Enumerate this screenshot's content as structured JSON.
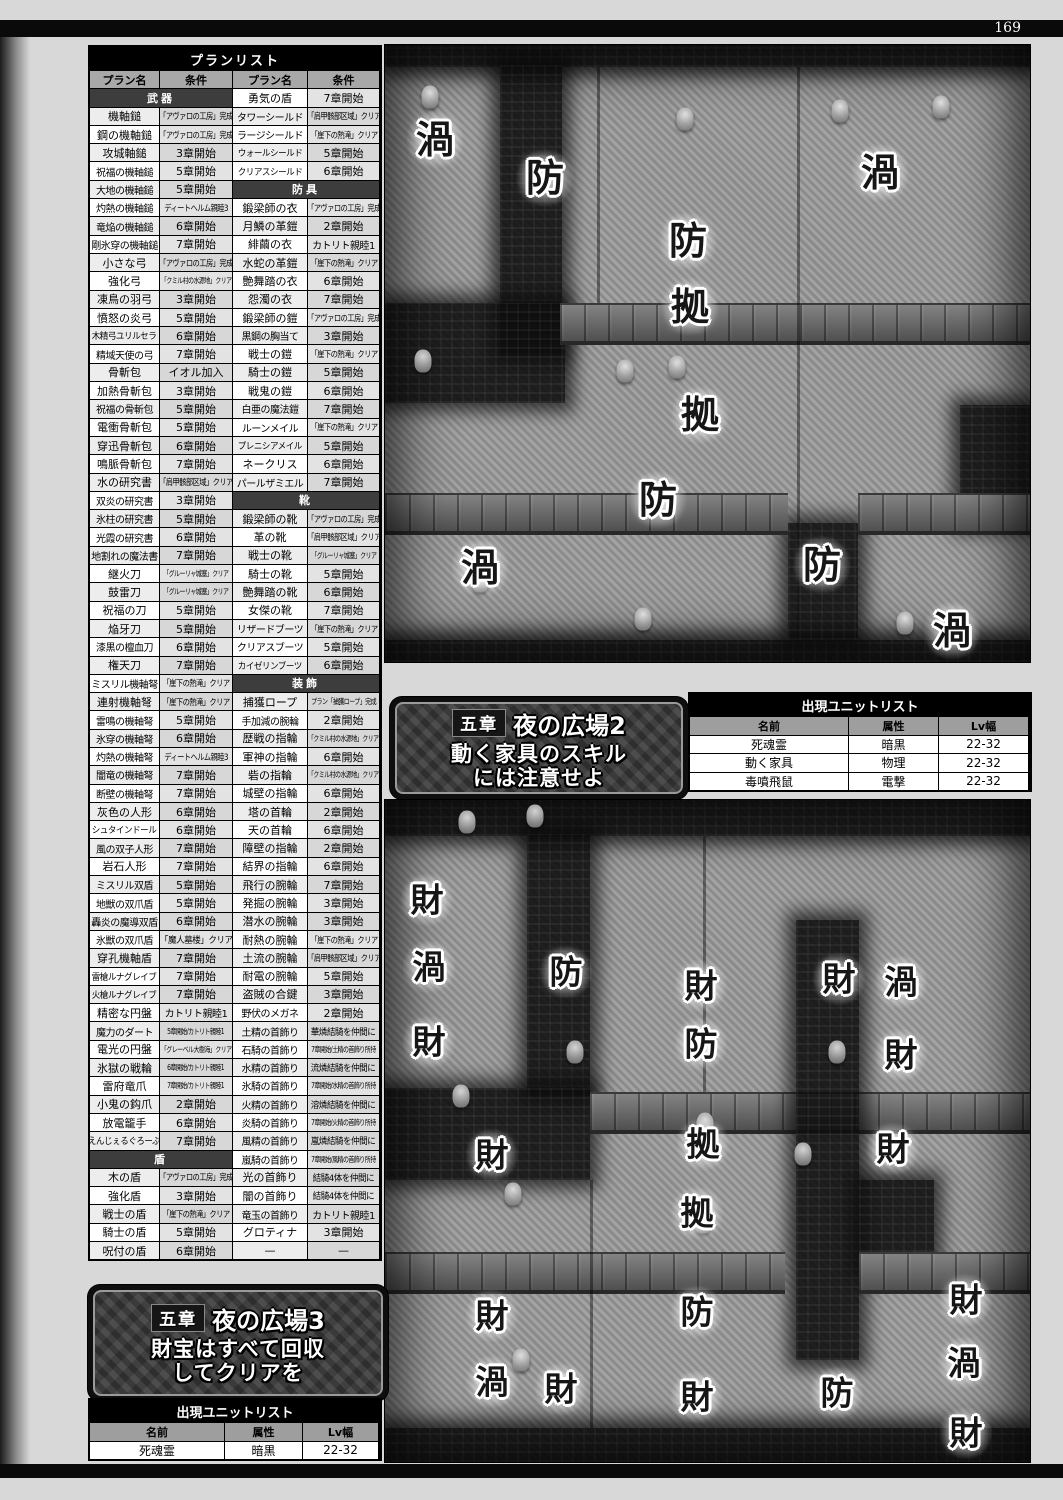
{
  "page": {
    "number": "169"
  },
  "plan_table": {
    "title": "プランリスト",
    "headers": [
      "プラン名",
      "条件",
      "プラン名",
      "条件"
    ],
    "rows": [
      {
        "ls": "武器",
        "r": [
          "勇気の盾",
          "7章開始"
        ]
      },
      {
        "l": [
          "機軸鎚",
          "「アヴァロの工房」完成"
        ],
        "r": [
          "タワーシールド",
          "「肩甲骸部区域」クリア"
        ]
      },
      {
        "l": [
          "鋼の機軸鎚",
          "「アヴァロの工房」完成"
        ],
        "r": [
          "ラージシールド",
          "「崖下の熱滝」クリア"
        ]
      },
      {
        "l": [
          "攻城軸鎚",
          "3章開始"
        ],
        "r": [
          "ウォールシールド",
          "5章開始"
        ]
      },
      {
        "l": [
          "祝福の機軸鎚",
          "5章開始"
        ],
        "r": [
          "クリアスシールド",
          "6章開始"
        ]
      },
      {
        "l": [
          "大地の機軸鎚",
          "5章開始"
        ],
        "rs": "防具"
      },
      {
        "l": [
          "灼熱の機軸鎚",
          "ディートヘルム親睦3"
        ],
        "r": [
          "鍛梁師の衣",
          "「アヴァロの工房」完成"
        ]
      },
      {
        "l": [
          "竜焔の機軸鎚",
          "6章開始"
        ],
        "r": [
          "月鱗の革鎧",
          "2章開始"
        ]
      },
      {
        "l": [
          "剛氷穿の機軸鎚",
          "7章開始"
        ],
        "r": [
          "緋繭の衣",
          "カトリト親睦1"
        ]
      },
      {
        "l": [
          "小さな弓",
          "「アヴァロの工房」完成"
        ],
        "r": [
          "水蛇の革鎧",
          "「崖下の熱滝」クリア"
        ]
      },
      {
        "l": [
          "強化弓",
          "「クミル村の水源地」クリア"
        ],
        "r": [
          "艶舞踏の衣",
          "6章開始"
        ]
      },
      {
        "l": [
          "凍鳥の羽弓",
          "3章開始"
        ],
        "r": [
          "怨濁の衣",
          "7章開始"
        ]
      },
      {
        "l": [
          "憤怒の炎弓",
          "5章開始"
        ],
        "r": [
          "鍛梁師の鎧",
          "「アヴァロの工房」完成"
        ]
      },
      {
        "l": [
          "木精弓ユリルセラ",
          "6章開始"
        ],
        "r": [
          "黒鋼の胸当て",
          "3章開始"
        ]
      },
      {
        "l": [
          "精域天使の弓",
          "7章開始"
        ],
        "r": [
          "戦士の鎧",
          "「崖下の熱滝」クリア"
        ]
      },
      {
        "l": [
          "骨斬包",
          "イオル加入"
        ],
        "r": [
          "騎士の鎧",
          "5章開始"
        ]
      },
      {
        "l": [
          "加熱骨斬包",
          "3章開始"
        ],
        "r": [
          "戦鬼の鎧",
          "6章開始"
        ]
      },
      {
        "l": [
          "祝福の骨斬包",
          "5章開始"
        ],
        "r": [
          "白亜の魔法鎧",
          "7章開始"
        ]
      },
      {
        "l": [
          "電衝骨斬包",
          "5章開始"
        ],
        "r": [
          "ルーンメイル",
          "「崖下の熱滝」クリア"
        ]
      },
      {
        "l": [
          "穿迅骨斬包",
          "6章開始"
        ],
        "r": [
          "プレニシアメイル",
          "5章開始"
        ]
      },
      {
        "l": [
          "鳴脈骨斬包",
          "7章開始"
        ],
        "r": [
          "ネークリス",
          "6章開始"
        ]
      },
      {
        "l": [
          "水の研究書",
          "「肩甲骸部区域」クリア"
        ],
        "r": [
          "パールザミエル",
          "7章開始"
        ]
      },
      {
        "l": [
          "双炎の研究書",
          "3章開始"
        ],
        "rs": "靴"
      },
      {
        "l": [
          "氷柱の研究書",
          "5章開始"
        ],
        "r": [
          "鍛梁師の靴",
          "「アヴァロの工房」完成"
        ]
      },
      {
        "l": [
          "光霞の研究書",
          "6章開始"
        ],
        "r": [
          "革の靴",
          "「肩甲骸部区域」クリア"
        ]
      },
      {
        "l": [
          "地割れの魔法書",
          "7章開始"
        ],
        "r": [
          "戦士の靴",
          "「グルーリャ城塞」クリア"
        ]
      },
      {
        "l": [
          "継火刀",
          "「グルーリャ城塞」クリア"
        ],
        "r": [
          "騎士の靴",
          "5章開始"
        ]
      },
      {
        "l": [
          "鼓雷刀",
          "「グルーリャ城塞」クリア"
        ],
        "r": [
          "艶舞踏の靴",
          "6章開始"
        ]
      },
      {
        "l": [
          "祝福の刀",
          "5章開始"
        ],
        "r": [
          "女傑の靴",
          "7章開始"
        ]
      },
      {
        "l": [
          "焔牙刀",
          "5章開始"
        ],
        "r": [
          "リザードブーツ",
          "「崖下の熱滝」クリア"
        ]
      },
      {
        "l": [
          "漆黒の檀血刀",
          "6章開始"
        ],
        "r": [
          "クリアスブーツ",
          "5章開始"
        ]
      },
      {
        "l": [
          "権天刀",
          "7章開始"
        ],
        "r": [
          "カイゼリンブーツ",
          "6章開始"
        ]
      },
      {
        "l": [
          "ミスリル機軸弩",
          "「崖下の熱滝」クリア"
        ],
        "rs": "装飾"
      },
      {
        "l": [
          "連射機軸弩",
          "「崖下の熱滝」クリア"
        ],
        "r": [
          "捕獲ロープ",
          "プラン「捕獲ロープ」完成"
        ]
      },
      {
        "l": [
          "雷鳴の機軸弩",
          "5章開始"
        ],
        "r": [
          "手加減の腕輪",
          "2章開始"
        ]
      },
      {
        "l": [
          "氷穿の機軸弩",
          "6章開始"
        ],
        "r": [
          "歴戦の指輪",
          "「クミル村の水源地」クリア"
        ]
      },
      {
        "l": [
          "灼熱の機軸弩",
          "ディートヘルム親睦3"
        ],
        "r": [
          "軍神の指輪",
          "6章開始"
        ]
      },
      {
        "l": [
          "闇竜の機軸弩",
          "7章開始"
        ],
        "r": [
          "砦の指輪",
          "「クミル村の水源地」クリア"
        ]
      },
      {
        "l": [
          "断壁の機軸弩",
          "7章開始"
        ],
        "r": [
          "城壁の指輪",
          "6章開始"
        ]
      },
      {
        "l": [
          "灰色の人形",
          "6章開始"
        ],
        "r": [
          "塔の首輪",
          "2章開始"
        ]
      },
      {
        "l": [
          "シュタインドール",
          "6章開始"
        ],
        "r": [
          "天の首輪",
          "6章開始"
        ]
      },
      {
        "l": [
          "風の双子人形",
          "7章開始"
        ],
        "r": [
          "障壁の指輪",
          "2章開始"
        ]
      },
      {
        "l": [
          "岩石人形",
          "7章開始"
        ],
        "r": [
          "結界の指輪",
          "6章開始"
        ]
      },
      {
        "l": [
          "ミスリル双盾",
          "5章開始"
        ],
        "r": [
          "飛行の腕輪",
          "7章開始"
        ]
      },
      {
        "l": [
          "地獣の双爪盾",
          "5章開始"
        ],
        "r": [
          "発掘の腕輪",
          "3章開始"
        ]
      },
      {
        "l": [
          "轟炎の魔導双盾",
          "6章開始"
        ],
        "r": [
          "潜水の腕輪",
          "3章開始"
        ]
      },
      {
        "l": [
          "氷獣の双爪盾",
          "「魔人墓楼」クリア"
        ],
        "r": [
          "耐熱の腕輪",
          "「崖下の熱滝」クリア"
        ]
      },
      {
        "l": [
          "穿孔機軸盾",
          "7章開始"
        ],
        "r": [
          "土流の腕輪",
          "「肩甲骸部区域」クリア"
        ]
      },
      {
        "l": [
          "雷槍ルナグレイブ",
          "7章開始"
        ],
        "r": [
          "耐電の腕輪",
          "5章開始"
        ]
      },
      {
        "l": [
          "火槍ルナグレイブ",
          "7章開始"
        ],
        "r": [
          "盗賊の合鍵",
          "3章開始"
        ]
      },
      {
        "l": [
          "精密な円盤",
          "カトリト親睦1"
        ],
        "r": [
          "野伏のメガネ",
          "2章開始"
        ]
      },
      {
        "l": [
          "魔力のダート",
          "5章開始/カトリト親睦1"
        ],
        "r": [
          "土精の首飾り",
          "華燐結騎を仲間に"
        ]
      },
      {
        "l": [
          "電光の円盤",
          "「グレーベル大樹海」クリア"
        ],
        "r": [
          "石騎の首飾り",
          "7章開始/土精の首飾り所持"
        ]
      },
      {
        "l": [
          "氷獄の戦輪",
          "6章開始/カトリト親睦1"
        ],
        "r": [
          "水精の首飾り",
          "流燐結騎を仲間に"
        ]
      },
      {
        "l": [
          "雷府竜爪",
          "7章開始/カトリト親睦1"
        ],
        "r": [
          "氷騎の首飾り",
          "7章開始/水精の首飾り所持"
        ]
      },
      {
        "l": [
          "小鬼の鈎爪",
          "2章開始"
        ],
        "r": [
          "火精の首飾り",
          "溶燐結騎を仲間に"
        ]
      },
      {
        "l": [
          "放電籠手",
          "6章開始"
        ],
        "r": [
          "炎騎の首飾り",
          "7章開始/火精の首飾り所持"
        ]
      },
      {
        "l": [
          "えんじぇるぐろーぶ",
          "7章開始"
        ],
        "r": [
          "風精の首飾り",
          "嵐燐結騎を仲間に"
        ]
      },
      {
        "ls": "盾",
        "r": [
          "嵐騎の首飾り",
          "7章開始/風精の首飾り所持"
        ]
      },
      {
        "l": [
          "木の盾",
          "「アヴァロの工房」完成"
        ],
        "r": [
          "光の首飾り",
          "結騎4体を仲間に"
        ]
      },
      {
        "l": [
          "強化盾",
          "3章開始"
        ],
        "r": [
          "闇の首飾り",
          "結騎4体を仲間に"
        ]
      },
      {
        "l": [
          "戦士の盾",
          "「崖下の熱滝」クリア"
        ],
        "r": [
          "竜玉の首飾り",
          "カトリト親睦1"
        ]
      },
      {
        "l": [
          "騎士の盾",
          "5章開始"
        ],
        "r": [
          "グロティナ",
          "3章開始"
        ]
      },
      {
        "l": [
          "呪付の盾",
          "6章開始"
        ],
        "r": [
          "—",
          "—"
        ]
      }
    ]
  },
  "banner2": {
    "chapter": "五章",
    "title": "夜の広場2",
    "line1": "動く家具のスキル",
    "line2": "には注意せよ"
  },
  "banner3": {
    "chapter": "五章",
    "title": "夜の広場3",
    "line1": "財宝はすべて回収",
    "line2": "してクリアを"
  },
  "unit_list_right": {
    "title": "出現ユニットリスト",
    "headers": [
      "名前",
      "属性",
      "Lv幅"
    ],
    "rows": [
      [
        "死魂霊",
        "暗黒",
        "22-32"
      ],
      [
        "動く家具",
        "物理",
        "22-32"
      ],
      [
        "毒噴飛鼠",
        "電撃",
        "22-32"
      ]
    ]
  },
  "unit_list_left": {
    "title": "出現ユニットリスト",
    "headers": [
      "名前",
      "属性",
      "Lv幅"
    ],
    "rows": [
      [
        "死魂霊",
        "暗黒",
        "22-32"
      ]
    ]
  },
  "maps": {
    "top": {
      "labels": [
        {
          "t": "渦",
          "kind": "whirl",
          "x": 50,
          "y": 95
        },
        {
          "t": "防",
          "kind": "defense",
          "x": 160,
          "y": 133
        },
        {
          "t": "渦",
          "kind": "whirl",
          "x": 495,
          "y": 128
        },
        {
          "t": "防",
          "kind": "defense",
          "x": 303,
          "y": 196
        },
        {
          "t": "拠",
          "kind": "base",
          "x": 305,
          "y": 262
        },
        {
          "t": "拠",
          "kind": "base",
          "x": 315,
          "y": 370
        },
        {
          "t": "防",
          "kind": "defense",
          "x": 273,
          "y": 455
        },
        {
          "t": "渦",
          "kind": "whirl",
          "x": 95,
          "y": 523
        },
        {
          "t": "防",
          "kind": "defense",
          "x": 437,
          "y": 520
        },
        {
          "t": "渦",
          "kind": "whirl",
          "x": 567,
          "y": 586
        }
      ],
      "sprites": [
        {
          "n": "ghost-sprite",
          "x": 45,
          "y": 52
        },
        {
          "n": "statue-sprite",
          "x": 300,
          "y": 74
        },
        {
          "n": "statue-sprite",
          "x": 455,
          "y": 66
        },
        {
          "n": "statue-sprite",
          "x": 556,
          "y": 62
        },
        {
          "n": "ghost-sprite",
          "x": 38,
          "y": 316
        },
        {
          "n": "ghost-sprite",
          "x": 240,
          "y": 326
        },
        {
          "n": "ghost-sprite",
          "x": 292,
          "y": 322
        },
        {
          "n": "ghost-sprite",
          "x": 95,
          "y": 536
        },
        {
          "n": "ghost-sprite",
          "x": 258,
          "y": 574
        },
        {
          "n": "ghost-sprite",
          "x": 520,
          "y": 578
        }
      ]
    },
    "bottom": {
      "labels": [
        {
          "t": "財",
          "kind": "treasure",
          "x": 42,
          "y": 100
        },
        {
          "t": "渦",
          "kind": "whirl",
          "x": 44,
          "y": 167
        },
        {
          "t": "防",
          "kind": "defense",
          "x": 181,
          "y": 172
        },
        {
          "t": "財",
          "kind": "treasure",
          "x": 316,
          "y": 186
        },
        {
          "t": "財",
          "kind": "treasure",
          "x": 454,
          "y": 179
        },
        {
          "t": "渦",
          "kind": "whirl",
          "x": 516,
          "y": 182
        },
        {
          "t": "財",
          "kind": "treasure",
          "x": 44,
          "y": 242
        },
        {
          "t": "防",
          "kind": "defense",
          "x": 316,
          "y": 244
        },
        {
          "t": "財",
          "kind": "treasure",
          "x": 516,
          "y": 255
        },
        {
          "t": "拠",
          "kind": "base",
          "x": 318,
          "y": 344
        },
        {
          "t": "財",
          "kind": "treasure",
          "x": 107,
          "y": 355
        },
        {
          "t": "財",
          "kind": "treasure",
          "x": 508,
          "y": 349
        },
        {
          "t": "拠",
          "kind": "base",
          "x": 312,
          "y": 413
        },
        {
          "t": "財",
          "kind": "treasure",
          "x": 107,
          "y": 516
        },
        {
          "t": "防",
          "kind": "defense",
          "x": 312,
          "y": 512
        },
        {
          "t": "財",
          "kind": "treasure",
          "x": 581,
          "y": 500
        },
        {
          "t": "渦",
          "kind": "whirl",
          "x": 107,
          "y": 582
        },
        {
          "t": "財",
          "kind": "treasure",
          "x": 176,
          "y": 589
        },
        {
          "t": "財",
          "kind": "treasure",
          "x": 312,
          "y": 597
        },
        {
          "t": "防",
          "kind": "defense",
          "x": 452,
          "y": 593
        },
        {
          "t": "渦",
          "kind": "whirl",
          "x": 579,
          "y": 563
        },
        {
          "t": "財",
          "kind": "treasure",
          "x": 581,
          "y": 633
        }
      ],
      "sprites": [
        {
          "n": "plant-sprite",
          "x": 82,
          "y": 22
        },
        {
          "n": "ghost-sprite",
          "x": 150,
          "y": 16
        },
        {
          "n": "statue-sprite",
          "x": 76,
          "y": 296
        },
        {
          "n": "statue-sprite",
          "x": 190,
          "y": 252
        },
        {
          "n": "statue-sprite",
          "x": 452,
          "y": 252
        },
        {
          "n": "statue-sprite",
          "x": 320,
          "y": 324
        },
        {
          "n": "figure-sprite",
          "x": 418,
          "y": 354
        },
        {
          "n": "figure-sprite",
          "x": 128,
          "y": 394
        },
        {
          "n": "ghost-sprite",
          "x": 318,
          "y": 422
        },
        {
          "n": "ghost-sprite",
          "x": 136,
          "y": 560
        }
      ]
    }
  }
}
